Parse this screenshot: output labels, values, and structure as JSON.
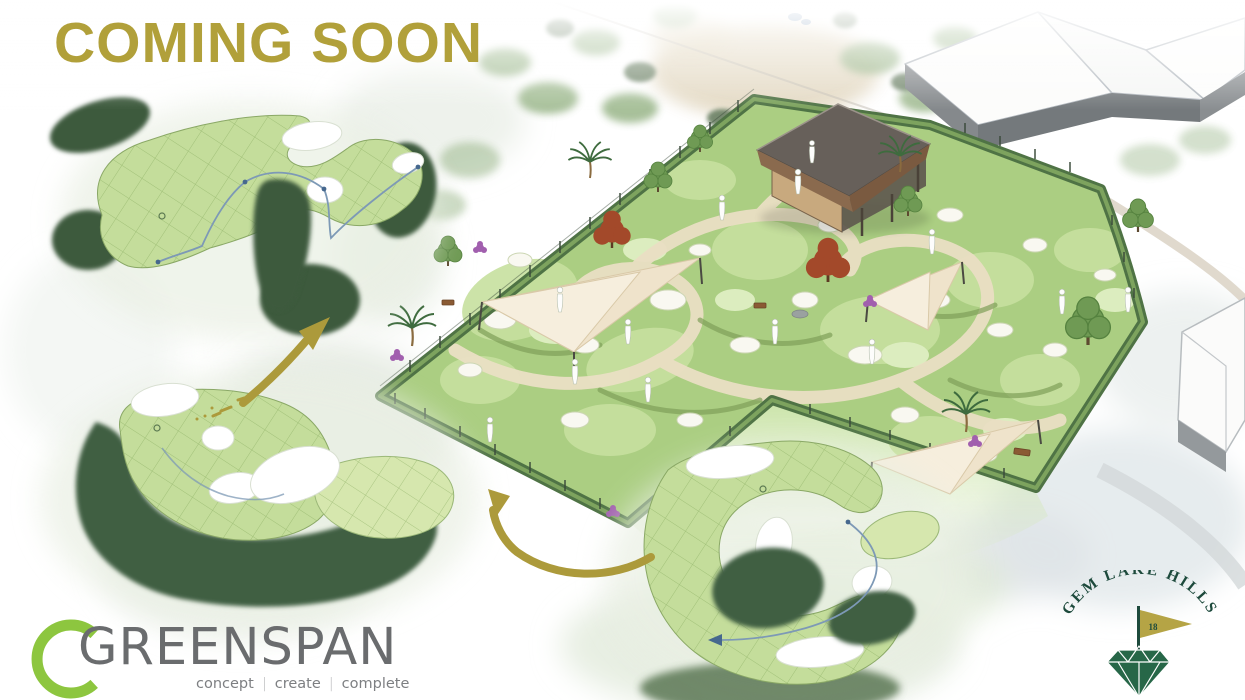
{
  "title": {
    "text": "COMING SOON",
    "color": "#b1a03a"
  },
  "annotations": {
    "arrow_color": "#ac9a3b"
  },
  "greenspan_logo": {
    "name": "GREENSPAN",
    "tagline_words": [
      "concept",
      "create",
      "complete"
    ],
    "tagline_separator": "|",
    "arc_color": "#8dc63f",
    "name_color": "#6a6c6e",
    "tagline_color": "#7d7f82"
  },
  "gem_lake_logo": {
    "name": "GEM LAKE HILLS",
    "flag_number": "18",
    "text_color": "#1d4a3c",
    "flag_color": "#b5a445",
    "gem_color": "#276748"
  },
  "scene": {
    "palette": {
      "course_green": "#abce82",
      "fairway_light": "#c7e09f",
      "rough_dark": "#4f7345",
      "sand_path": "#eadfc4",
      "bunker_white": "#f9f8f1",
      "shade_sail_cream": "#efe3cb",
      "pavilion_roof": "#67605a",
      "autumn_tree": "#a3492a",
      "ball_path_blue": "#7d99b6",
      "watercolor_wash": "#e3eae0"
    }
  }
}
